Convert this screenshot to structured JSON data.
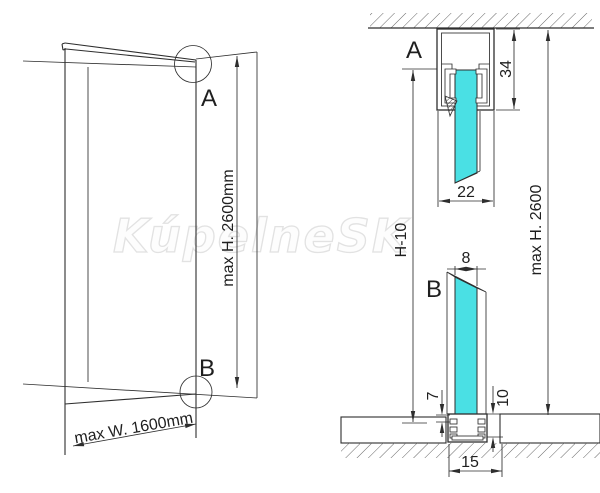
{
  "watermark": "KúpelneSK",
  "colors": {
    "glass": "#4ae0e4",
    "line": "#2e2e2e",
    "dim-text": "#1f1f1f",
    "watermark-stroke": "#e2e2e2",
    "background": "#ffffff"
  },
  "left_view": {
    "marker_a": "A",
    "marker_b": "B",
    "max_height": "max H. 2600mm",
    "max_width": "max W. 1600mm"
  },
  "detail_a": {
    "label": "A",
    "profile_height_mm": "34",
    "profile_width_mm": "22"
  },
  "detail_b": {
    "label": "B",
    "glass_thickness_mm": "8",
    "profile_lip_mm": "7",
    "recess_depth_mm": "10",
    "recess_width_mm": "15"
  },
  "shared": {
    "glass_height": "H-10",
    "max_height": "max H. 2600"
  }
}
